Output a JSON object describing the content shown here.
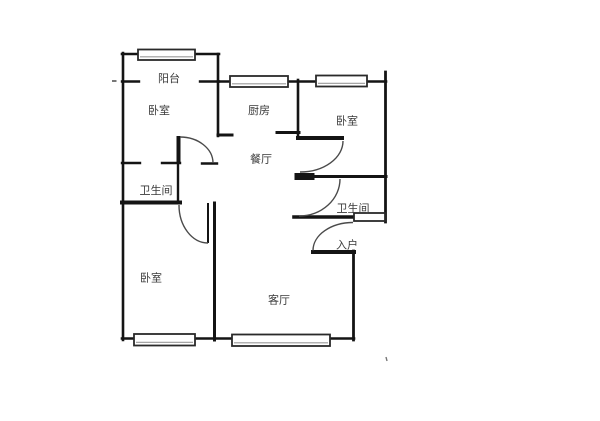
{
  "document": {
    "type": "apartment-floor-plan",
    "background": "#ffffff"
  },
  "colors": {
    "wall": "#141414",
    "door_arc": "#4a4a4a",
    "window_fill": "#ffffff",
    "window_border": "#2a2a2a",
    "window_inner": "#9a9a9a",
    "text": "#3a3a3a",
    "mark": "#777777"
  },
  "rooms": [
    {
      "id": "balcony",
      "label": "阳台",
      "cx": 169,
      "cy": 78.5
    },
    {
      "id": "bedroom-1",
      "label": "卧室",
      "cx": 159,
      "cy": 110.5
    },
    {
      "id": "kitchen",
      "label": "厨房",
      "cx": 259,
      "cy": 110.5
    },
    {
      "id": "bedroom-2",
      "label": "卧室",
      "cx": 347,
      "cy": 121
    },
    {
      "id": "dining-room",
      "label": "餐厅",
      "cx": 261,
      "cy": 159
    },
    {
      "id": "bathroom-1",
      "label": "卫生间",
      "cx": 156,
      "cy": 190.5
    },
    {
      "id": "bathroom-2",
      "label": "卫生间",
      "cx": 353,
      "cy": 208.5
    },
    {
      "id": "entry",
      "label": "入户",
      "cx": 347,
      "cy": 245
    },
    {
      "id": "bedroom-3",
      "label": "卧室",
      "cx": 151,
      "cy": 278
    },
    {
      "id": "living-room",
      "label": "客厅",
      "cx": 279,
      "cy": 300
    }
  ],
  "floorplan": {
    "canvas": {
      "width": 600,
      "height": 421
    },
    "label_font_size": 11,
    "walls": [
      {
        "x1": 123,
        "y1": 53,
        "x2": 123,
        "y2": 340,
        "w": 2.6
      },
      {
        "x1": 122,
        "y1": 54,
        "x2": 219,
        "y2": 54,
        "w": 2.6
      },
      {
        "x1": 218,
        "y1": 54,
        "x2": 218,
        "y2": 136,
        "w": 2.6
      },
      {
        "x1": 122,
        "y1": 81.5,
        "x2": 139,
        "y2": 81.5,
        "w": 2.4
      },
      {
        "x1": 200,
        "y1": 81.5,
        "x2": 219,
        "y2": 81.5,
        "w": 2.4
      },
      {
        "x1": 218,
        "y1": 81.5,
        "x2": 386,
        "y2": 81.5,
        "w": 2.6
      },
      {
        "x1": 298,
        "y1": 80,
        "x2": 298,
        "y2": 138,
        "w": 2.6
      },
      {
        "x1": 385.5,
        "y1": 72,
        "x2": 385.5,
        "y2": 222,
        "w": 2.8
      },
      {
        "x1": 122,
        "y1": 163,
        "x2": 140,
        "y2": 163,
        "w": 2.4
      },
      {
        "x1": 162,
        "y1": 163,
        "x2": 180,
        "y2": 163,
        "w": 2.4
      },
      {
        "x1": 202,
        "y1": 163.5,
        "x2": 217,
        "y2": 163.5,
        "w": 2.4
      },
      {
        "x1": 178,
        "y1": 163,
        "x2": 178,
        "y2": 203,
        "w": 2.4
      },
      {
        "x1": 122,
        "y1": 202.5,
        "x2": 180,
        "y2": 202.5,
        "w": 4
      },
      {
        "x1": 214.5,
        "y1": 203,
        "x2": 214.5,
        "y2": 340,
        "w": 3
      },
      {
        "x1": 218,
        "y1": 135,
        "x2": 232,
        "y2": 135,
        "w": 3
      },
      {
        "x1": 277,
        "y1": 132.5,
        "x2": 299,
        "y2": 132.5,
        "w": 3
      },
      {
        "x1": 298,
        "y1": 138,
        "x2": 342,
        "y2": 138,
        "w": 4
      },
      {
        "x1": 299,
        "y1": 176.5,
        "x2": 386,
        "y2": 176.5,
        "w": 3
      },
      {
        "x1": 298,
        "y1": 176.5,
        "x2": 311,
        "y2": 176.5,
        "w": 7
      },
      {
        "x1": 294,
        "y1": 217,
        "x2": 354,
        "y2": 217,
        "w": 3.6
      },
      {
        "x1": 313,
        "y1": 252,
        "x2": 354,
        "y2": 252,
        "w": 4
      },
      {
        "x1": 353.5,
        "y1": 251,
        "x2": 353.5,
        "y2": 340,
        "w": 2.8
      },
      {
        "x1": 122,
        "y1": 338.5,
        "x2": 354,
        "y2": 338.5,
        "w": 2.6
      }
    ],
    "door_leaves": [
      {
        "x1": 178.5,
        "y1": 136,
        "x2": 178.5,
        "y2": 163,
        "w": 4
      },
      {
        "x1": 208,
        "y1": 203,
        "x2": 208,
        "y2": 243,
        "w": 2
      }
    ],
    "door_arcs": [
      {
        "d": "M 180 137 A 33 26 0 0 1 213 163"
      },
      {
        "d": "M 179 205 A 29 38 0 0 0 208 243"
      },
      {
        "d": "M 343 141 A 43 31 0 0 1 300 172"
      },
      {
        "d": "M 340 179 A 41 37 0 0 1 299 216"
      },
      {
        "d": "M 353 222.5 A 40 28 0 0 0 313 250.5"
      }
    ],
    "windows": [
      {
        "x": 138,
        "y": 49.5,
        "w": 57,
        "h": 10.5
      },
      {
        "x": 230,
        "y": 76,
        "w": 58,
        "h": 11
      },
      {
        "x": 316,
        "y": 75.5,
        "w": 51,
        "h": 11
      },
      {
        "x": 354,
        "y": 213,
        "w": 31,
        "h": 8
      },
      {
        "x": 134,
        "y": 334,
        "w": 61,
        "h": 11.5
      },
      {
        "x": 232,
        "y": 334.5,
        "w": 98,
        "h": 11.5
      }
    ],
    "stray_marks": [
      {
        "x1": 112,
        "y1": 81,
        "x2": 116.5,
        "y2": 81,
        "w": 2
      },
      {
        "x1": 386,
        "y1": 357,
        "x2": 387,
        "y2": 361,
        "w": 1.4
      }
    ]
  }
}
